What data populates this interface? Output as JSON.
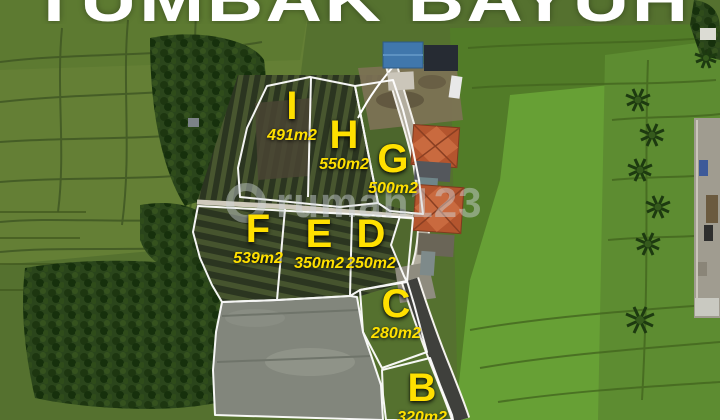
{
  "title": "TUMBAK BAYUH",
  "watermark": {
    "text": "rumah123"
  },
  "plots": [
    {
      "letter": "I",
      "area": "491m2"
    },
    {
      "letter": "H",
      "area": "550m2"
    },
    {
      "letter": "G",
      "area": "500m2"
    },
    {
      "letter": "F",
      "area": "539m2"
    },
    {
      "letter": "E",
      "area": "350m2"
    },
    {
      "letter": "D",
      "area": "250m2"
    },
    {
      "letter": "C",
      "area": "280m2"
    },
    {
      "letter": "B",
      "area": "320m2"
    }
  ],
  "colors": {
    "label_yellow": "#FFE000",
    "boundary_white": "#FFFFFF",
    "roof_orange": "#B85C33",
    "roof_blue": "#4077AC"
  }
}
